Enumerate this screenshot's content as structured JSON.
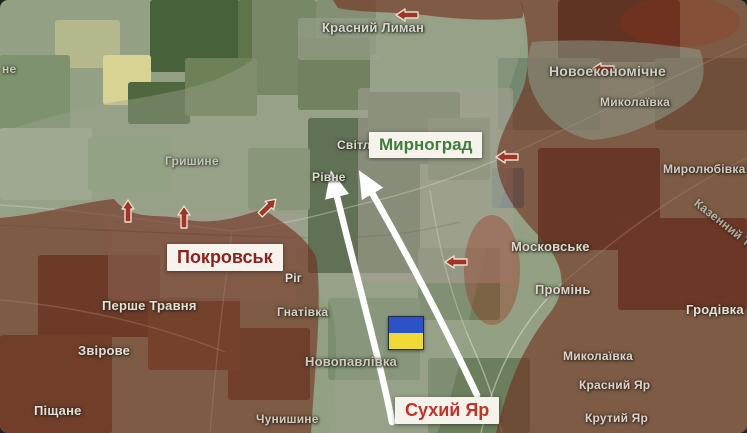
{
  "map": {
    "title_boxes": {
      "myrnohrad": "Мирноград",
      "pokrovsk": "Покровськ",
      "sukhyi_yar": "Сухий Яр"
    },
    "colors": {
      "occupied_zone": "#702d1d",
      "contested_zone": "#9aa38f",
      "pocket_zone": "#8fa393",
      "accent_red": "#9c2c18",
      "arrow_red": "#a03428",
      "arrow_red_outline": "#ecdccb",
      "arrow_white": "#ffffff",
      "road": "rgba(240,238,228,0.45)",
      "railway": "rgba(70,60,50,0.3)",
      "flag_blue": "#2b52c6",
      "flag_yellow": "#f0d935"
    },
    "flag": {
      "x": 388,
      "y": 316,
      "w": 34,
      "h": 32
    },
    "place_labels": [
      {
        "text": "Красний Лиман",
        "x": 322,
        "y": 20,
        "size": 13,
        "color": "#d8d8d2"
      },
      {
        "text": "Новоекономічне",
        "x": 549,
        "y": 63,
        "size": 14,
        "color": "#d0cdc4"
      },
      {
        "text": "Миколаївка",
        "x": 600,
        "y": 95,
        "size": 12,
        "color": "#cfc9bf"
      },
      {
        "text": "Миролюбівка",
        "x": 663,
        "y": 162,
        "size": 12,
        "color": "#d6c9c2"
      },
      {
        "text": "Світле",
        "x": 337,
        "y": 138,
        "size": 12,
        "color": "#dcdcd2"
      },
      {
        "text": "Рівне",
        "x": 312,
        "y": 170,
        "size": 12,
        "color": "#dcdcd2"
      },
      {
        "text": "Гришине",
        "x": 165,
        "y": 154,
        "size": 12,
        "color": "#cfd0c6",
        "opacity": 0.75
      },
      {
        "text": "Ріг",
        "x": 285,
        "y": 271,
        "size": 12,
        "color": "#e2e0d8"
      },
      {
        "text": "Гнатівка",
        "x": 277,
        "y": 305,
        "size": 12,
        "color": "#d8d2c6"
      },
      {
        "text": "Новопавлівка",
        "x": 305,
        "y": 354,
        "size": 13,
        "color": "#cfcabc"
      },
      {
        "text": "Чунишине",
        "x": 256,
        "y": 412,
        "size": 12,
        "color": "#d8c7b8"
      },
      {
        "text": "Перше Травня",
        "x": 102,
        "y": 298,
        "size": 13,
        "color": "#e8ddd4"
      },
      {
        "text": "Звірове",
        "x": 78,
        "y": 343,
        "size": 13,
        "color": "#e8ddd4"
      },
      {
        "text": "Піщане",
        "x": 34,
        "y": 403,
        "size": 13,
        "color": "#e8ddd4"
      },
      {
        "text": "Московське",
        "x": 511,
        "y": 239,
        "size": 13,
        "color": "#e0d4cc"
      },
      {
        "text": "Промінь",
        "x": 535,
        "y": 282,
        "size": 13,
        "color": "#e0d4cc"
      },
      {
        "text": "Гродівка",
        "x": 686,
        "y": 302,
        "size": 13,
        "color": "#e8dcd4"
      },
      {
        "text": "Миколаївка",
        "x": 563,
        "y": 349,
        "size": 12,
        "color": "#e0d0c8"
      },
      {
        "text": "Красний Яр",
        "x": 579,
        "y": 378,
        "size": 12,
        "color": "#e0d0c8"
      },
      {
        "text": "Крутий Яр",
        "x": 585,
        "y": 411,
        "size": 12,
        "color": "#e0d0c8"
      },
      {
        "text": "Казенний Т.",
        "x": 700,
        "y": 196,
        "size": 12,
        "color": "#cfd8cc",
        "opacity": 0.7,
        "rotate": 38
      },
      {
        "text": "не",
        "x": 2,
        "y": 62,
        "size": 12,
        "color": "#d8d8d2",
        "opacity": 0.8
      }
    ],
    "red_arrow_glyph": "M -11,0 L -2,-6 L -2,-3 L 11,-3 L 11,3 L -2,3 L -2,6 Z",
    "red_arrows": [
      {
        "x": 407,
        "y": 15,
        "rot": 0
      },
      {
        "x": 603,
        "y": 69,
        "rot": 0
      },
      {
        "x": 507,
        "y": 157,
        "rot": 0
      },
      {
        "x": 456,
        "y": 262,
        "rot": 0
      },
      {
        "x": 128,
        "y": 211,
        "rot": 90
      },
      {
        "x": 184,
        "y": 217,
        "rot": 90
      },
      {
        "x": 268,
        "y": 207,
        "rot": 135
      }
    ],
    "white_arrows": [
      {
        "path": "M 392,422 C 380,360 352,260 335,188"
      },
      {
        "path": "M 477,395 C 444,325 404,248 368,186"
      }
    ],
    "zones": {
      "occupied": [
        "M 520,0 L 747,0 L 747,433 L 496,433 C 505,395 518,355 546,318 C 572,288 562,262 541,238 C 515,212 499,188 497,163 C 495,138 514,114 524,86 C 531,60 528,25 520,0 Z",
        "M 333,0 L 520,0 C 524,8 524,14 522,18 C 480,22 448,18 415,14 C 385,12 355,12 338,8 Z",
        "M 0,218 C 45,214 82,202 114,199 C 132,222 158,213 184,219 C 214,226 242,216 263,209 C 288,226 306,237 316,257 C 323,300 315,365 311,433 L 0,433 Z"
      ],
      "contested": "M 252,0 L 518,0 C 526,28 521,58 509,88 C 516,128 511,168 501,203 C 486,248 473,298 463,348 C 453,393 444,418 437,433 L 330,433 C 334,386 341,341 331,306 C 303,273 281,253 261,237 C 217,233 176,231 149,225 C 111,229 56,231 0,225 L 0,132 C 40,120 80,107 120,101 C 170,93 216,86 252,60 Z",
      "pocket": "M 532,42 C 590,38 660,42 700,50 C 708,72 702,92 688,102 C 660,122 625,138 592,140 C 562,134 540,115 530,85 C 526,70 527,55 532,42 Z",
      "accents": [
        {
          "cx": 492,
          "cy": 270,
          "rx": 28,
          "ry": 55,
          "opacity": 0.35
        },
        {
          "cx": 680,
          "cy": 22,
          "rx": 60,
          "ry": 25,
          "opacity": 0.25
        }
      ]
    },
    "roads": [
      "M 0,205 C 80,210 160,222 232,231 C 290,224 330,212 362,204 C 420,191 470,172 520,150 C 590,118 660,82 747,44",
      "M 232,231 C 224,290 216,360 210,433",
      "M 747,158 C 700,180 650,210 560,285 C 520,325 495,370 481,433",
      "M 430,190 C 438,245 452,300 472,345 C 484,372 495,400 502,433",
      "M 0,300 C 70,306 150,322 225,352"
    ],
    "railway": "M 0,225 C 100,230 220,236 320,238 C 380,238 420,232 460,222",
    "terrain": [
      {
        "x": 150,
        "y": 0,
        "w": 90,
        "h": 72,
        "c": "#47613b"
      },
      {
        "x": 238,
        "y": 0,
        "w": 78,
        "h": 95,
        "c": "#5f7549"
      },
      {
        "x": 316,
        "y": 0,
        "w": 60,
        "h": 55,
        "c": "#74845c"
      },
      {
        "x": 55,
        "y": 20,
        "w": 65,
        "h": 48,
        "c": "#b5b88c"
      },
      {
        "x": 103,
        "y": 55,
        "w": 48,
        "h": 50,
        "c": "#d8d392"
      },
      {
        "x": 0,
        "y": 55,
        "w": 70,
        "h": 75,
        "c": "#7f926f"
      },
      {
        "x": 128,
        "y": 82,
        "w": 62,
        "h": 42,
        "c": "#50663f"
      },
      {
        "x": 185,
        "y": 58,
        "w": 72,
        "h": 58,
        "c": "#6e8056"
      },
      {
        "x": 0,
        "y": 128,
        "w": 92,
        "h": 72,
        "c": "#a2ad92"
      },
      {
        "x": 88,
        "y": 138,
        "w": 84,
        "h": 52,
        "c": "#8da07f"
      },
      {
        "x": 298,
        "y": 38,
        "w": 72,
        "h": 72,
        "c": "#55693f"
      },
      {
        "x": 308,
        "y": 118,
        "w": 112,
        "h": 155,
        "c": "#374f2e"
      },
      {
        "x": 368,
        "y": 92,
        "w": 92,
        "h": 72,
        "c": "#465f38"
      },
      {
        "x": 428,
        "y": 118,
        "w": 62,
        "h": 62,
        "c": "#617a52"
      },
      {
        "x": 248,
        "y": 148,
        "w": 62,
        "h": 62,
        "c": "#7d8d6c"
      },
      {
        "x": 418,
        "y": 248,
        "w": 82,
        "h": 72,
        "c": "#6e8160"
      },
      {
        "x": 328,
        "y": 298,
        "w": 92,
        "h": 82,
        "c": "#7b8f6e"
      },
      {
        "x": 228,
        "y": 328,
        "w": 82,
        "h": 72,
        "c": "#6e5a43"
      },
      {
        "x": 38,
        "y": 255,
        "w": 122,
        "h": 82,
        "c": "#6b4e3a"
      },
      {
        "x": 0,
        "y": 335,
        "w": 112,
        "h": 98,
        "c": "#745740"
      },
      {
        "x": 148,
        "y": 298,
        "w": 92,
        "h": 72,
        "c": "#7b5f45"
      },
      {
        "x": 538,
        "y": 148,
        "w": 122,
        "h": 102,
        "c": "#5d4737"
      },
      {
        "x": 558,
        "y": 0,
        "w": 122,
        "h": 62,
        "c": "#4b3d2f"
      },
      {
        "x": 618,
        "y": 218,
        "w": 129,
        "h": 92,
        "c": "#644a39"
      },
      {
        "x": 428,
        "y": 358,
        "w": 102,
        "h": 75,
        "c": "#6c7e5d"
      },
      {
        "x": 498,
        "y": 58,
        "w": 102,
        "h": 72,
        "c": "#74886e"
      },
      {
        "x": 655,
        "y": 58,
        "w": 92,
        "h": 72,
        "c": "#708266"
      },
      {
        "x": 492,
        "y": 168,
        "w": 32,
        "h": 40,
        "c": "#5e7d80"
      },
      {
        "x": 108,
        "y": 213,
        "w": 192,
        "h": 88,
        "c": "#a39c8d",
        "o": 0.75
      },
      {
        "x": 358,
        "y": 88,
        "w": 155,
        "h": 195,
        "c": "#a59f92",
        "o": 0.6
      },
      {
        "x": 298,
        "y": 18,
        "w": 82,
        "h": 42,
        "c": "#9aa48f",
        "o": 0.6
      }
    ]
  }
}
